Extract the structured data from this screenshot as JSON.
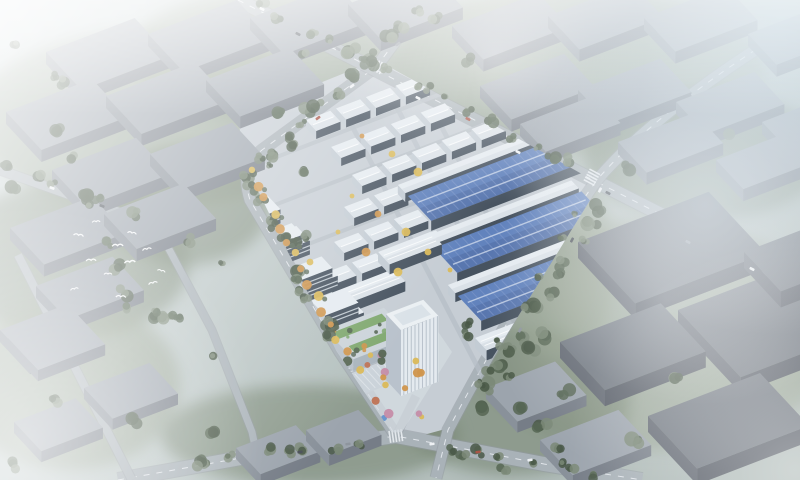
{
  "scene": {
    "title": "Aerial rendering of a planned industrial logistics park in hazy daylight",
    "type": "architectural bird's-eye visualization",
    "regions": {
      "park_center": "grid of white standard factory warehouses",
      "park_right": "three large blue metal-roof logistics warehouses",
      "park_west": "tree-lined boulevard with autumn trees and mid-rise office blocks",
      "park_south": "white headquarters tower with landscaped green podium and striped parking plaza",
      "surroundings": "existing grey factory blocks fading into white haze",
      "left_sky": "flock of white birds",
      "roads": "diagonal arterial roads with intersections, a small roundabout and scattered cars"
    }
  },
  "palette": {
    "ground": "#b9c2c0",
    "ground2": "#a9b4ae",
    "grass": "#8e9a85",
    "grass-dark": "#76836e",
    "tree": "#4e5d48",
    "tree-dark": "#3f4d3a",
    "road": "#a8afb5",
    "road-edge": "#8f969d",
    "marking": "#eef1f4",
    "park-ground": "#c7cdd3",
    "lane": "#b6bcc3",
    "roof-white": "#e9edf1",
    "roof-shade": "#d5dbe2",
    "wall-side": "#c4cbd3",
    "wall-dark": "#3d4855",
    "roof-blue": "#5b7cba",
    "roof-blue-dark": "#49659f",
    "blue-rib": "#8199cc",
    "blue-streak": "#cfd9ec",
    "box-top": "#9aa0a9",
    "box-side": "#858b94",
    "box-front": "#70767f",
    "dark-top": "#6a6f78",
    "dark-side": "#575c65",
    "dark-front": "#4b5059",
    "tower-face": "#e8ecf0",
    "tower-side": "#b9c1ca",
    "tower-stripe": "#a9b2bd",
    "green-roof": "#7ca568",
    "tree-orange": "#d29040",
    "tree-yellow": "#ddb74d",
    "tree-pink": "#c687a2",
    "tree-red": "#bf6a4a",
    "car-white": "#f2f4f6",
    "car-dark": "#40454c",
    "car-red": "#a84a3a",
    "bird": "#ffffff",
    "haze": "#ffffff",
    "fog-blue": "#c2d4e0"
  }
}
